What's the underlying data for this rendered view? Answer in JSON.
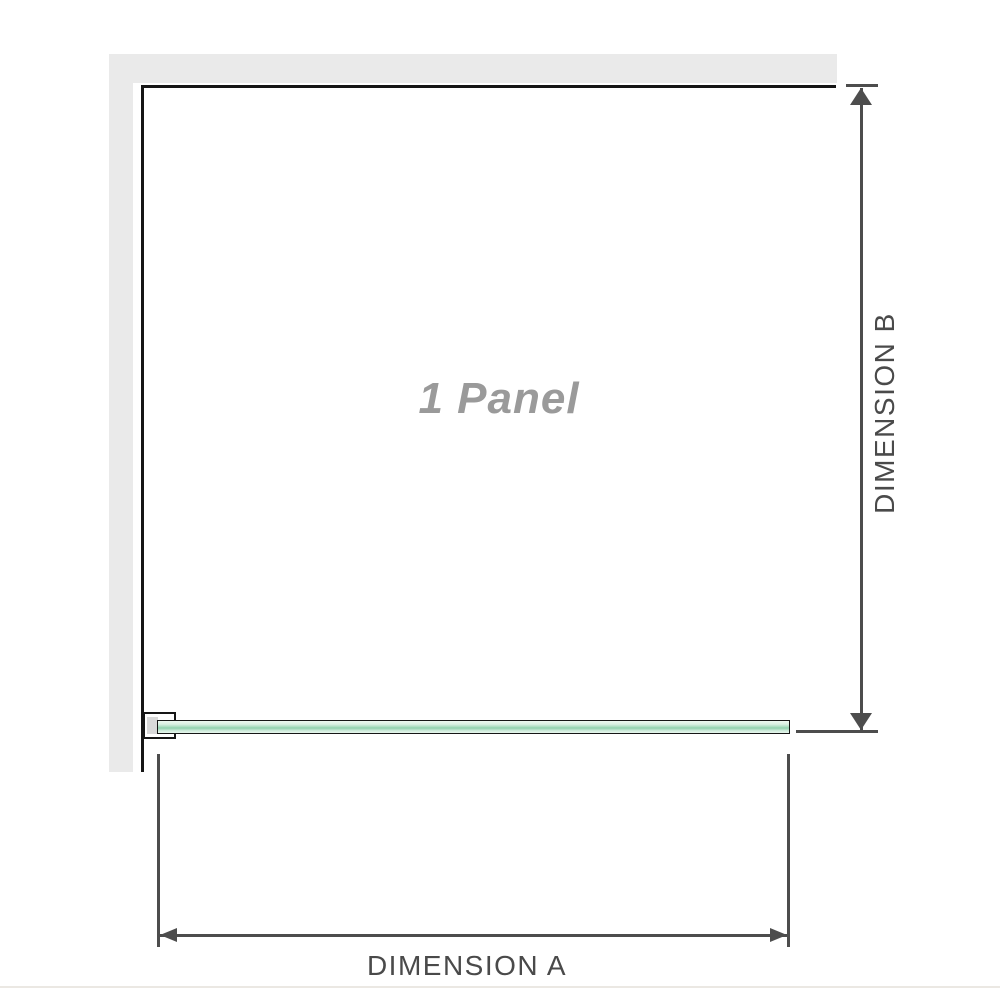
{
  "diagram": {
    "panel_label": "1 Panel",
    "dimension_a_label": "DIMENSION A",
    "dimension_b_label": "DIMENSION B"
  },
  "colors": {
    "background": "#ffffff",
    "wall": "#eaeaea",
    "panel_border": "#161616",
    "glass_light": "#e7f6ed",
    "glass_mid": "#a6dbbe",
    "glass_core": "#8fd0ac",
    "bracket_pad": "#d9d9d9",
    "dimension_line": "#4d4d4d",
    "dimension_text": "#4a4a4a",
    "watermark_text": "#9a9a9a",
    "bottom_divider": "#ebe8e3"
  }
}
